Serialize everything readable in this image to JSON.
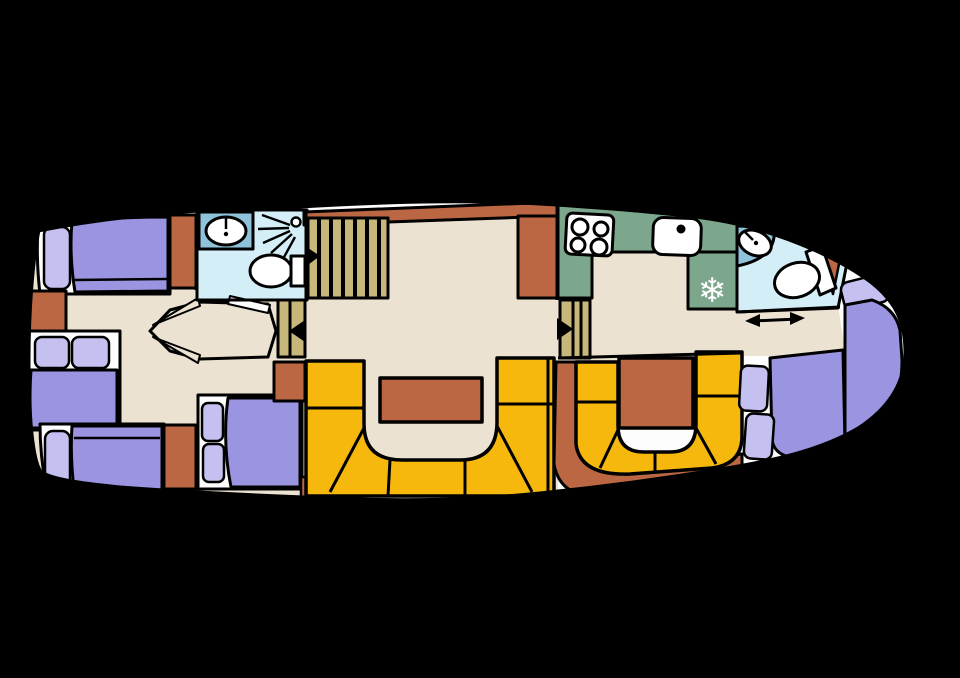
{
  "image": {
    "description": "Top-down deck floor plan of a motor yacht on a black background"
  },
  "colors": {
    "background": "#000000",
    "line": "#000000",
    "hull": "#fdfdfd",
    "floor": "#ece2d1",
    "bed": "#9a94e1",
    "pillow": "#c4c0f0",
    "sofa": "#f7b80d",
    "terracotta": "#bb6743",
    "galley": "#7ca78c",
    "bath": "#d4eef7",
    "bath_counter": "#8fc3da",
    "stairs": "#c8b77a",
    "fixture": "#ffffff",
    "snowflake": "#ffffff"
  },
  "icons": {
    "freezer_glyph": "❄"
  }
}
